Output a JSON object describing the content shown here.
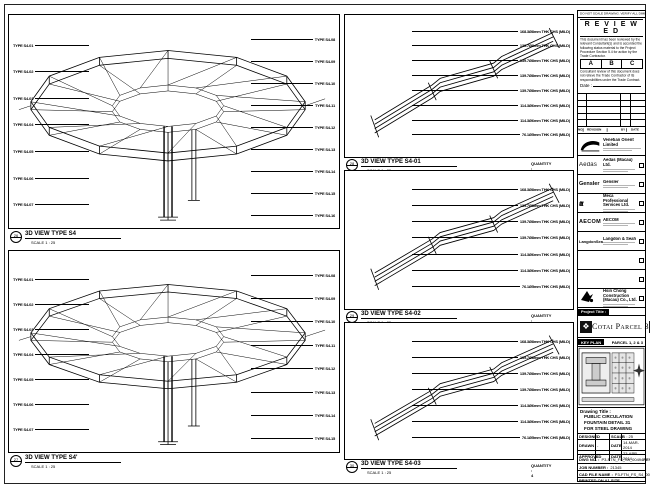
{
  "panels": {
    "left": [
      {
        "callout_top": "26",
        "callout_bottom": "-",
        "title": "3D VIEW TYPE S4",
        "scale": "SCALE 1 : 25",
        "left_annotations": [
          "TYPE S4-01",
          "TYPE S4-02",
          "TYPE S4-03",
          "TYPE S4-04",
          "TYPE S4-05",
          "TYPE S4-06",
          "TYPE S4-07"
        ],
        "right_annotations": [
          "TYPE S4-08",
          "TYPE S4-09",
          "TYPE S4-10",
          "TYPE S4-11",
          "TYPE S4-12",
          "TYPE S4-13",
          "TYPE S4-14",
          "TYPE S4-15",
          "TYPE S4-16"
        ]
      },
      {
        "callout_top": "27",
        "callout_bottom": "-",
        "title": "3D VIEW TYPE S4'",
        "scale": "SCALE 1 : 25",
        "left_annotations": [
          "TYPE S4-01",
          "TYPE S4-02",
          "TYPE S4-03",
          "TYPE S4-04",
          "TYPE S4-05",
          "TYPE S4-06",
          "TYPE S4-07"
        ],
        "right_annotations": [
          "TYPE S4-08",
          "TYPE S4-09",
          "TYPE S4-10",
          "TYPE S4-11",
          "TYPE S4-12",
          "TYPE S4-13",
          "TYPE S4-14",
          "TYPE S4-15"
        ]
      }
    ],
    "middle": [
      {
        "callout_top": "28",
        "callout_bottom": "-",
        "title": "3D VIEW TYPE S4-01",
        "scale": "SCALE 1 : 25",
        "quantity": "QUANTITY : 4",
        "annotations": [
          "168.3Ø8mm THK CHS (MILD)",
          "139.7Ø8mm THK CHS (MILD)",
          "139.7Ø8mm THK CHS (MILD)",
          "139.7Ø8mm THK CHS (MILD)",
          "139.7Ø8mm THK CHS (MILD)",
          "114.3Ø6mm THK CHS (MILD)",
          "114.3Ø6mm THK CHS (MILD)",
          "76.1Ø5mm THK CHS (MILD)"
        ]
      },
      {
        "callout_top": "29",
        "callout_bottom": "-",
        "title": "3D VIEW TYPE S4-02",
        "scale": "SCALE 1 : 25",
        "quantity": "QUANTITY : 4",
        "annotations": [
          "168.3Ø8mm THK CHS (MILD)",
          "139.7Ø8mm THK CHS (MILD)",
          "139.7Ø8mm THK CHS (MILD)",
          "139.7Ø8mm THK CHS (MILD)",
          "114.3Ø6mm THK CHS (MILD)",
          "114.3Ø6mm THK CHS (MILD)",
          "76.1Ø5mm THK CHS (MILD)"
        ]
      },
      {
        "callout_top": "30",
        "callout_bottom": "-",
        "title": "3D VIEW TYPE S4-03",
        "scale": "SCALE 1 : 25",
        "quantity": "QUANTITY : 4",
        "annotations": [
          "168.3Ø8mm THK CHS (MILD)",
          "139.7Ø8mm THK CHS (MILD)",
          "139.7Ø8mm THK CHS (MILD)",
          "139.7Ø8mm THK CHS (MILD)",
          "114.3Ø6mm THK CHS (MILD)",
          "114.3Ø6mm THK CHS (MILD)",
          "76.1Ø5mm THK CHS (MILD)"
        ]
      }
    ]
  },
  "titleblock": {
    "top_note": "DO NOT SCALE DRAWING. VERIFY ALL DIMENSIONS ON SITE.",
    "reviewed": {
      "title": "R E V I E W E D",
      "body": "This document has been reviewed by the relevant Consultant(s) and is accorded the following status material to the Project Procedure Section 5.4 for action by the Trade Contractor.",
      "options": [
        "A",
        "B",
        "C"
      ],
      "note": "Consultant review of this document does not relieve the Trade Contractor of its responsibilities under the Trade Contract.",
      "date_label": "Date :"
    },
    "revision_headers": [
      "NO.",
      "REVISION",
      "BY",
      "DATE"
    ],
    "owner": {
      "name": "Venetian Orient Limited"
    },
    "consultants": [
      {
        "logo": "Aedas",
        "name": "Aedas (Macau) Ltd."
      },
      {
        "logo": "Gensler",
        "name": "Gensler"
      },
      {
        "logo": "ttt",
        "name": "Meca Professional Services Ltd."
      },
      {
        "logo": "AECOM",
        "name": "AECOM"
      },
      {
        "logo": "LangdonSeah",
        "name": "Langdon & Seah"
      },
      {
        "logo": "",
        "name": ""
      },
      {
        "logo": "",
        "name": ""
      },
      {
        "logo": "",
        "name": "Hsin Chong Construction (Macau) Co., Ltd."
      }
    ],
    "project_label": "Project Title :",
    "project_title": "Cotai Parcel 3",
    "key_plan": {
      "label": "KEY PLAN",
      "parcel": "PARCEL 1, 2 & 3"
    },
    "drawing_title_label": "Drawing Title :",
    "drawing_title_lines": [
      "PUBLIC CIRCULATION",
      "FOUNTAIN DETAIL 31",
      "FOR STEEL DRAWING"
    ],
    "fields": [
      {
        "label": "DESIGNED",
        "value": "-",
        "label2": "SCALE",
        "value2": "1 : 25"
      },
      {
        "label": "DRAWN",
        "value": "-",
        "label2": "DATE",
        "value2": "14-MAR-2014"
      },
      {
        "label": "APPROVED",
        "value": "-",
        "label2": "DATE",
        "value2": "23-APR-2014"
      }
    ],
    "dwg_no_label": "DWG NO. :",
    "dwg_no": "P3-FTN_FS_S4_00494",
    "rev_label": "REV. :",
    "rev": "A",
    "job_label": "JOB NUMBER :",
    "job": "21345",
    "cad_label": "CAD FILE NAME :",
    "cad": "P3-FTN_FS_S4_00494.DWG",
    "print_note": "PRINTED ON A1 SIZE"
  }
}
